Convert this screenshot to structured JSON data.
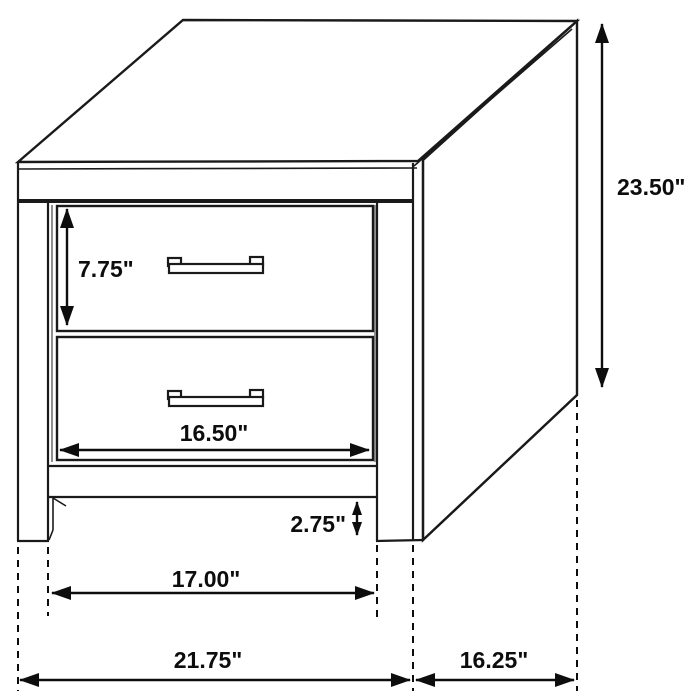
{
  "figure": {
    "background": "#ffffff",
    "line_color": "#1a1a1a",
    "recess_gray": "#8f8f8f",
    "text_color": "#0d0d0d"
  },
  "dims": {
    "overall_height": "23.50\"",
    "top_drawer_height": "7.75\"",
    "drawer_width": "16.50\"",
    "base_clearance": "2.75\"",
    "leg_inner_span": "17.00\"",
    "overall_width": "21.75\"",
    "side_depth": "16.25\""
  }
}
